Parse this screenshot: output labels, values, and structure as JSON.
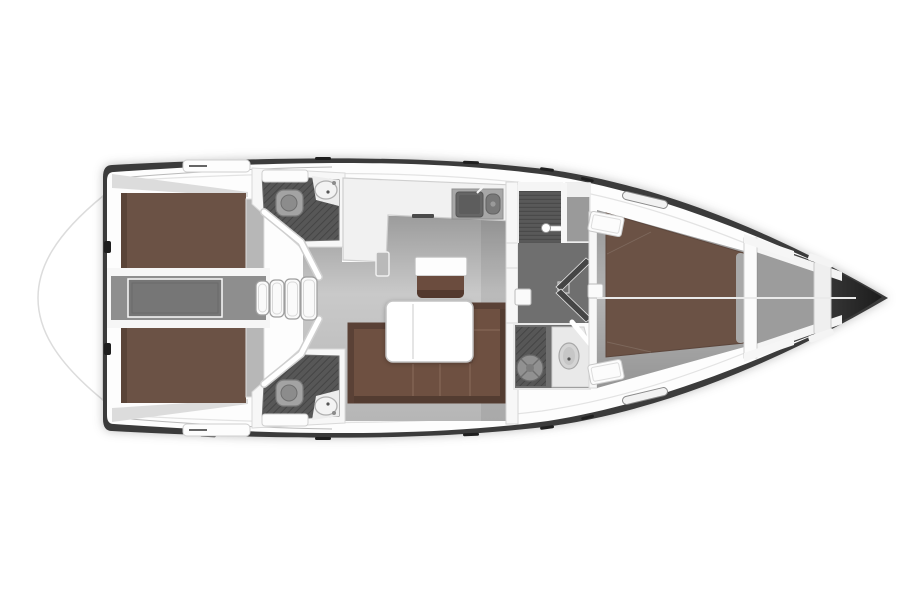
{
  "meta": {
    "title": "Sailing yacht interior layout — top-down floor plan",
    "view": "top-down",
    "type": "yacht-floor-plan"
  },
  "colors": {
    "background": "#ffffff",
    "hull_dark": "#3b3b3b",
    "bow_tip": "#1b1b1b",
    "deck_white": "#fdfdfd",
    "platform_line": "#dcdcdc",
    "floor_top": "#9c9c9c",
    "floor_mid": "#c9c9c9",
    "floor_bottom": "#b6b6b6",
    "corridor_gray": "#6f6f6f",
    "engine_room_gray": "#8e8e8e",
    "engine_box_gray": "#767676",
    "berth_brown": "#6b5245",
    "berth_edge_brown": "#5a4438",
    "sofa_brown": "#6e5041",
    "sofa_edge_brown": "#533c31",
    "seat_brown": "#6b4c3e",
    "pad_gray": "#b7b7b7",
    "wet_floor_gray": "#575757",
    "wet_hatch_gray": "#454545",
    "shower_slat_gray": "#595959",
    "locker_gray": "#9c9c9c",
    "wall_white": "#f7f7f7",
    "outline_gray": "#cfcfcf",
    "sink_dark_gray": "#666666",
    "fixture_gray": "#a3a3a3",
    "tick_black": "#1f1f1f"
  },
  "rooms": [
    {
      "id": "swim-platform",
      "label": "Swim platform"
    },
    {
      "id": "aft-cabin-port",
      "label": "Aft double cabin (top)"
    },
    {
      "id": "aft-cabin-starboard",
      "label": "Aft double cabin (bottom)"
    },
    {
      "id": "aft-head-port",
      "label": "Aft head with shower (top)"
    },
    {
      "id": "aft-head-starboard",
      "label": "Aft head with shower (bottom)"
    },
    {
      "id": "engine-room",
      "label": "Engine compartment"
    },
    {
      "id": "companionway",
      "label": "Companionway steps"
    },
    {
      "id": "salon",
      "label": "Salon with U-sofa and folding table"
    },
    {
      "id": "galley",
      "label": "L-shaped galley with twin sink"
    },
    {
      "id": "nav-station",
      "label": "Side table with seat"
    },
    {
      "id": "shower-cabin",
      "label": "Separate shower cabin"
    },
    {
      "id": "forward-head",
      "label": "Forward head"
    },
    {
      "id": "corridor",
      "label": "Corridor with double doors"
    },
    {
      "id": "forward-cabin",
      "label": "Forward owner's cabin with V-berth"
    },
    {
      "id": "anchor-locker",
      "label": "Anchor locker / bow"
    }
  ],
  "fixtures": [
    "toilet",
    "washbasin",
    "twin-sink",
    "shower-grating",
    "companionway-steps",
    "folding-table",
    "engine-box",
    "deck-hatch",
    "genoa-track",
    "windlass-bulkhead",
    "centerline-seam"
  ]
}
